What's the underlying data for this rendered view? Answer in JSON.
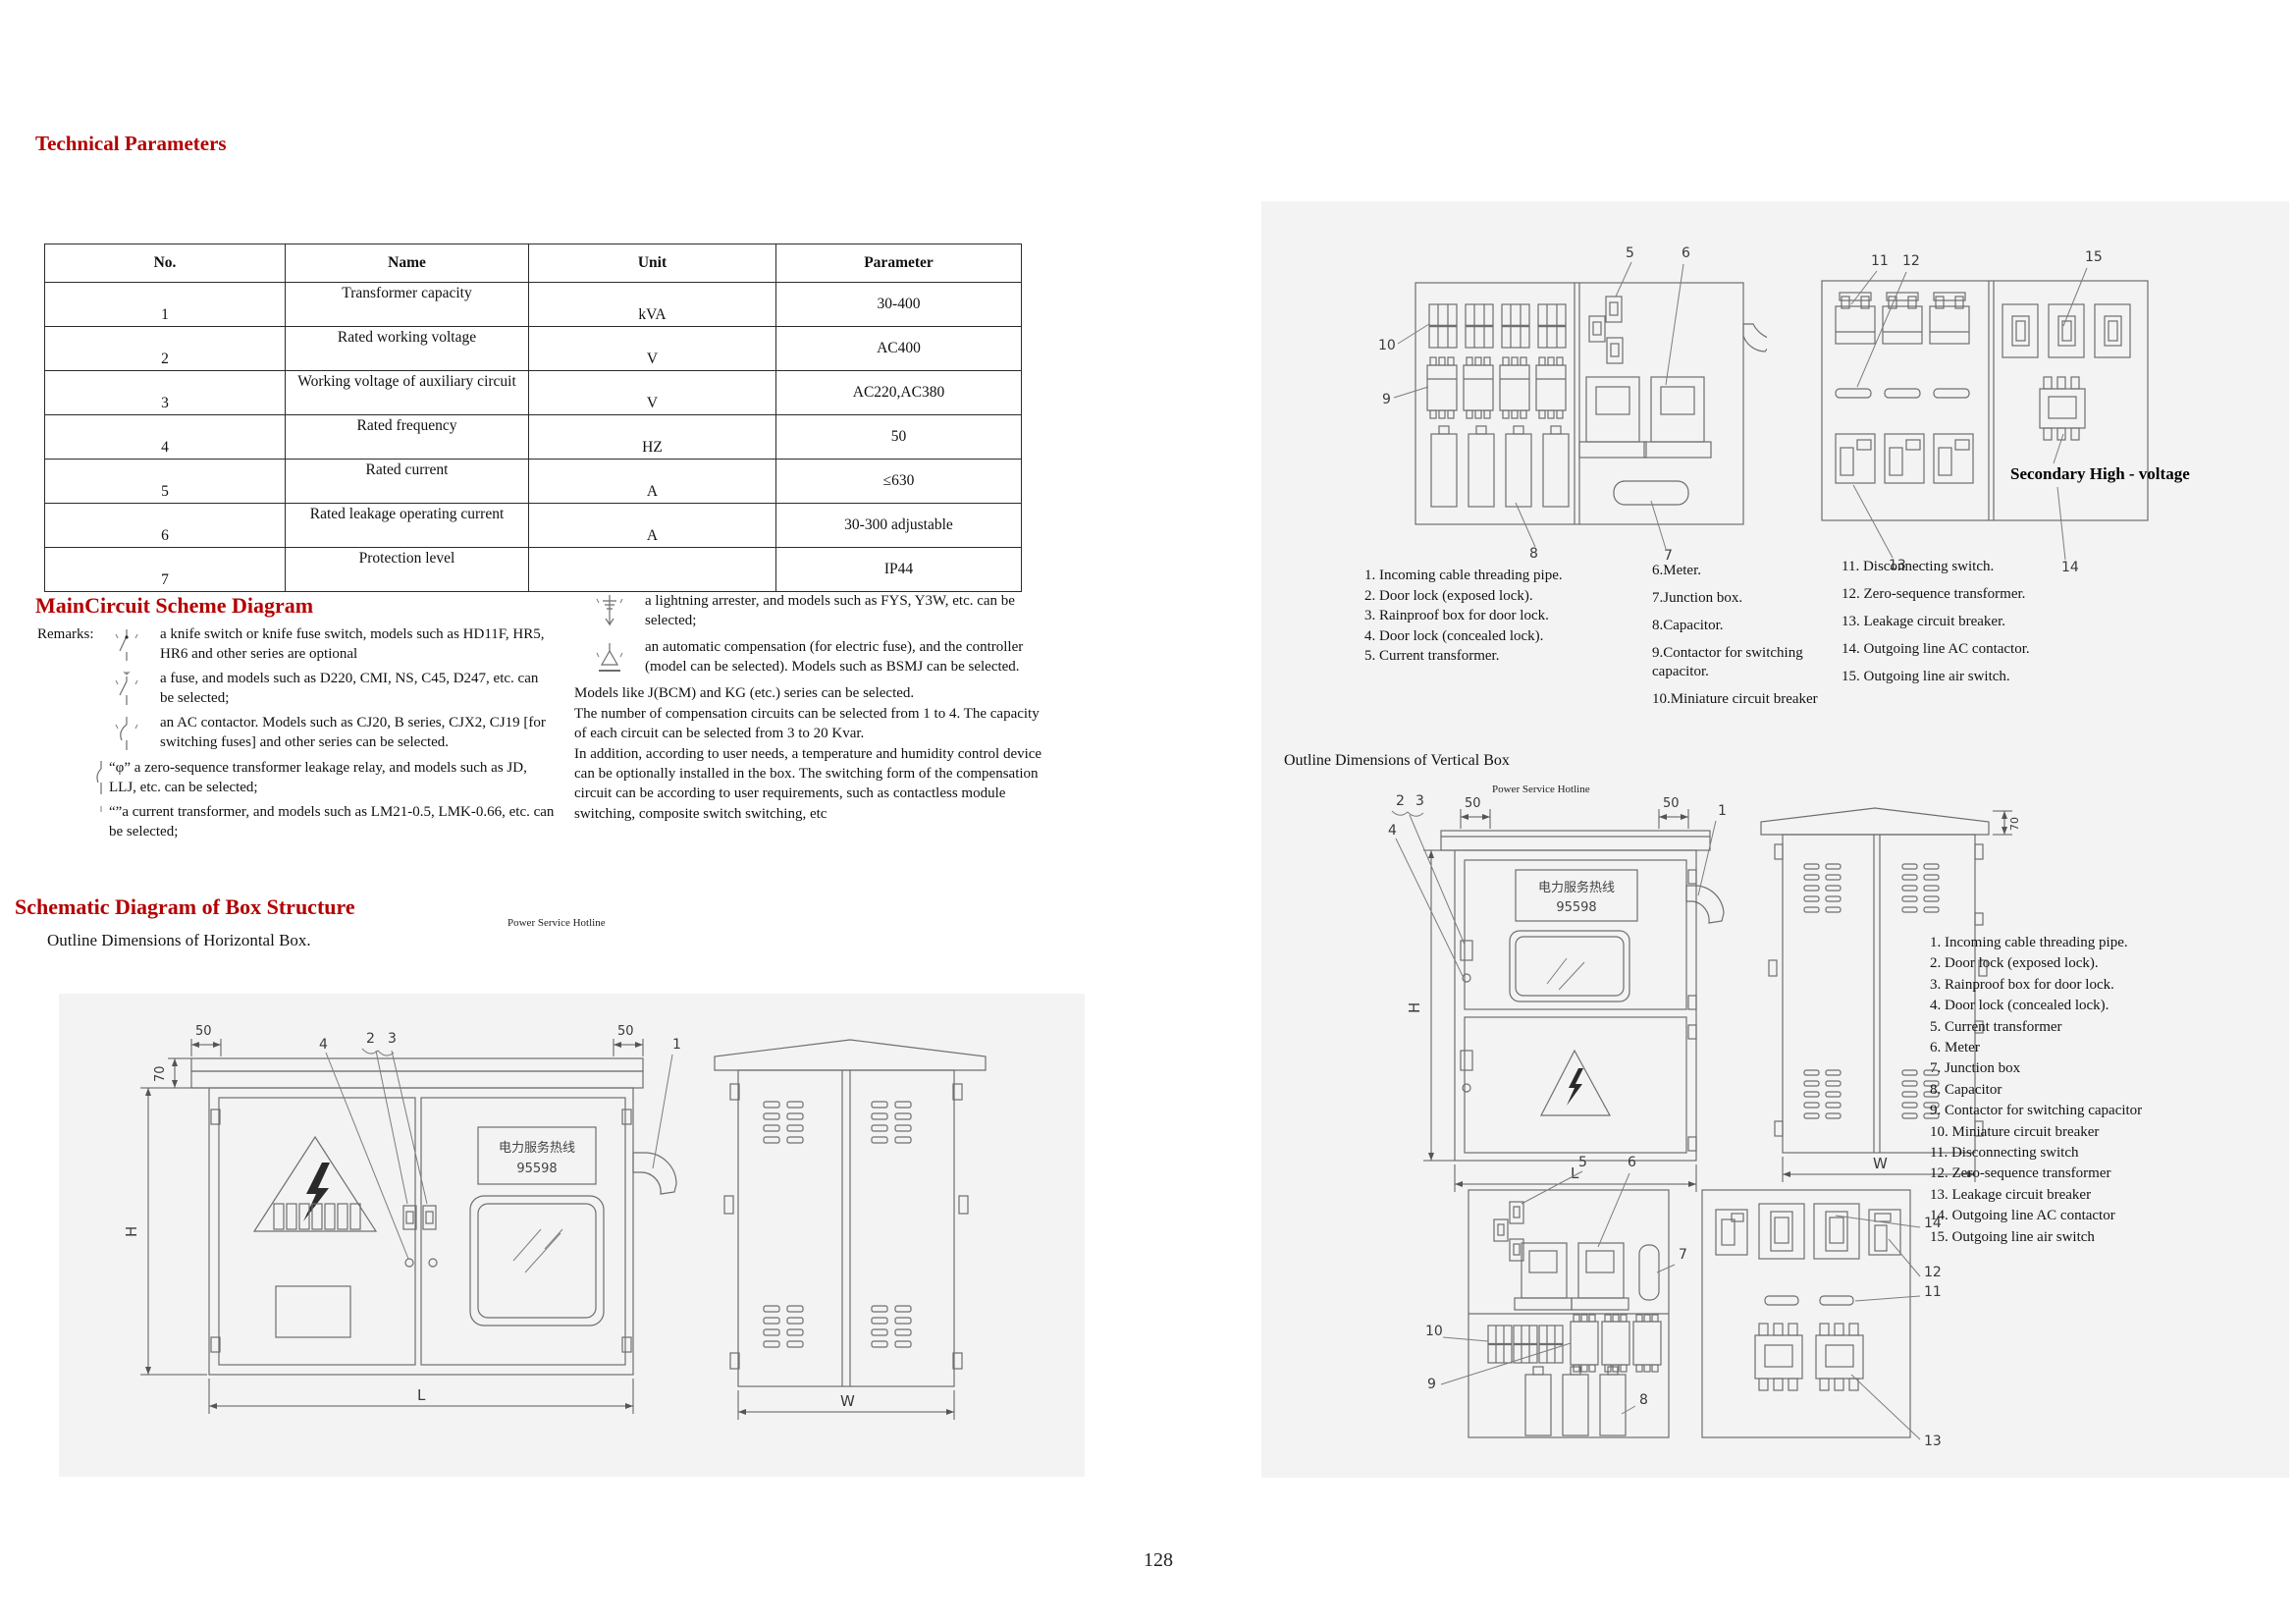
{
  "page": {
    "number": "128"
  },
  "colors": {
    "accent_red": "#b30000"
  },
  "technical_parameters": {
    "title": "Technical Parameters",
    "table": {
      "headers": [
        "No.",
        "Name",
        "Unit",
        "Parameter"
      ],
      "rows": [
        {
          "no": "1",
          "name": "Transformer capacity",
          "unit": "kVA",
          "parameter": "30-400"
        },
        {
          "no": "2",
          "name": "Rated working voltage",
          "unit": "V",
          "parameter": "AC400"
        },
        {
          "no": "3",
          "name": "Working voltage of auxiliary circuit",
          "unit": "V",
          "parameter": "AC220,AC380"
        },
        {
          "no": "4",
          "name": "Rated frequency",
          "unit": "HZ",
          "parameter": "50"
        },
        {
          "no": "5",
          "name": "Rated current",
          "unit": "A",
          "parameter": "≤630"
        },
        {
          "no": "6",
          "name": "Rated leakage operating current",
          "unit": "A",
          "parameter": "30-300 adjustable"
        },
        {
          "no": "7",
          "name": "Protection level",
          "unit": "",
          "parameter": "IP44"
        }
      ]
    }
  },
  "main_circuit": {
    "title": "MainCircuit Scheme Diagram",
    "remarks_label": "Remarks:",
    "symbol_items": [
      {
        "symbol": "knife-switch-symbol",
        "text": "a knife switch or knife fuse switch, models such as HD11F, HR5, HR6 and other series are optional"
      },
      {
        "symbol": "fuse-symbol",
        "text": "a fuse, and models such as D220, CMI, NS, C45, D247, etc. can be selected;"
      },
      {
        "symbol": "ac-contactor-symbol",
        "text": "an AC contactor. Models such as CJ20, B series, CJX2, CJ19 [for switching fuses] and other series can be selected."
      },
      {
        "symbol": "zero-sequence-relay-symbol",
        "text": "“φ”  a zero-sequence transformer leakage relay, and models such as JD, LLJ, etc. can be selected;"
      },
      {
        "symbol": "current-transformer-symbol",
        "text": "“”a current transformer, and models such as LM21-0.5, LMK-0.66, etc. can be selected;"
      }
    ],
    "right_items": [
      {
        "symbol": "lightning-arrester-symbol",
        "text": "a lightning arrester, and models such as FYS, Y3W, etc. can be selected;"
      },
      {
        "symbol": "auto-compensation-symbol",
        "text": "an automatic compensation (for electric fuse), and the controller (model can be selected). Models such as BSMJ can be selected."
      }
    ],
    "paragraph_lines": [
      "Models like J(BCM) and KG (etc.) series can be selected.",
      "The number of compensation circuits can be selected from 1 to 4. The capacity of each circuit can be selected from 3 to 20 Kvar.",
      "In addition, according to user needs, a temperature and humidity control device can be optionally installed in the box. The switching form of the compensation circuit can be according to user requirements, such as contactless module switching, composite switch switching, etc"
    ]
  },
  "box_structure": {
    "title": "Schematic Diagram of Box Structure",
    "horizontal_caption": "Outline Dimensions of Horizontal Box.",
    "vertical_caption": "Outline Dimensions of Vertical Box",
    "hotline_caption": "Power Service Hotline",
    "plate": {
      "line1": "电力服务热线",
      "line2": "95598"
    },
    "secondary_label": "Secondary High - voltage",
    "dims": {
      "d50": "50",
      "d70": "70",
      "H": "H",
      "L": "L",
      "W": "W"
    }
  },
  "callouts": {
    "c1": "1",
    "c2": "2",
    "c3": "3",
    "c4": "4",
    "c5": "5",
    "c6": "6",
    "c7": "7",
    "c8": "8",
    "c9": "9",
    "c10": "10",
    "c11": "11",
    "c12": "12",
    "c13": "13",
    "c14": "14",
    "c15": "15"
  },
  "legend_top": {
    "col1": [
      "1.   Incoming cable threading pipe.",
      "2. Door lock (exposed lock).",
      "3. Rainproof box for door lock.",
      "4. Door lock (concealed lock).",
      "5. Current transformer."
    ],
    "col2": [
      "6.Meter.",
      "7.Junction box.",
      "8.Capacitor.",
      "9.Contactor for switching capacitor.",
      "10.Miniature circuit breaker"
    ],
    "col3": [
      "11. Disconnecting switch.",
      "12. Zero-sequence transformer.",
      "13. Leakage circuit breaker.",
      "14. Outgoing line AC contactor.",
      "15. Outgoing line air switch."
    ]
  },
  "legend_right": [
    "1. Incoming cable threading pipe.",
    "2. Door lock (exposed lock).",
    "3. Rainproof box for door lock.",
    "4. Door lock (concealed lock).",
    "5. Current transformer",
    "6. Meter",
    "7. Junction box",
    "8. Capacitor",
    "9. Contactor for switching capacitor",
    "10. Miniature circuit breaker",
    "11. Disconnecting switch",
    "12. Zero-sequence transformer",
    "13. Leakage circuit breaker",
    "14. Outgoing line AC contactor",
    "15. Outgoing line air switch"
  ]
}
